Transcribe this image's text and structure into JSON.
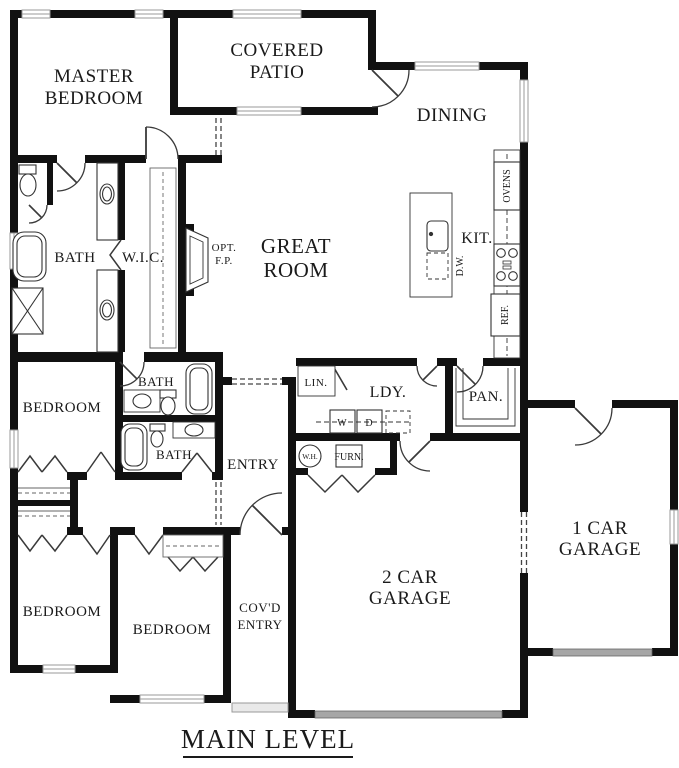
{
  "title": "MAIN LEVEL",
  "rooms": {
    "master_bedroom": {
      "line1": "MASTER",
      "line2": "BEDROOM"
    },
    "covered_patio": {
      "line1": "COVERED",
      "line2": "PATIO"
    },
    "dining": {
      "label": "DINING"
    },
    "great_room": {
      "line1": "GREAT",
      "line2": "ROOM"
    },
    "kitchen": {
      "label": "KIT."
    },
    "master_bath": {
      "label": "BATH"
    },
    "walk_in_closet": {
      "label": "W.I.C."
    },
    "optional_fireplace": {
      "line1": "OPT.",
      "line2": "F.P."
    },
    "hall_bath": {
      "label": "BATH"
    },
    "bedroom_2": {
      "label": "BEDROOM"
    },
    "bath_3": {
      "label": "BATH"
    },
    "entry": {
      "label": "ENTRY"
    },
    "linen": {
      "label": "LIN."
    },
    "laundry": {
      "label": "LDY."
    },
    "pantry": {
      "label": "PAN."
    },
    "bedroom_3": {
      "label": "BEDROOM"
    },
    "bedroom_4": {
      "label": "BEDROOM"
    },
    "covered_entry": {
      "line1": "COV'D",
      "line2": "ENTRY"
    },
    "garage_2car": {
      "line1": "2 CAR",
      "line2": "GARAGE"
    },
    "garage_1car": {
      "line1": "1 CAR",
      "line2": "GARAGE"
    }
  },
  "appliances": {
    "ovens": "OVENS",
    "refrigerator": "REF.",
    "dishwasher": "D.W.",
    "washer": "W",
    "dryer": "D",
    "water_heater": "W.H.",
    "furnace": "FURN."
  },
  "colors": {
    "wall": "#111111",
    "line": "#333333",
    "window_frame": "#999999",
    "garage_door": "#a6a6a6"
  }
}
